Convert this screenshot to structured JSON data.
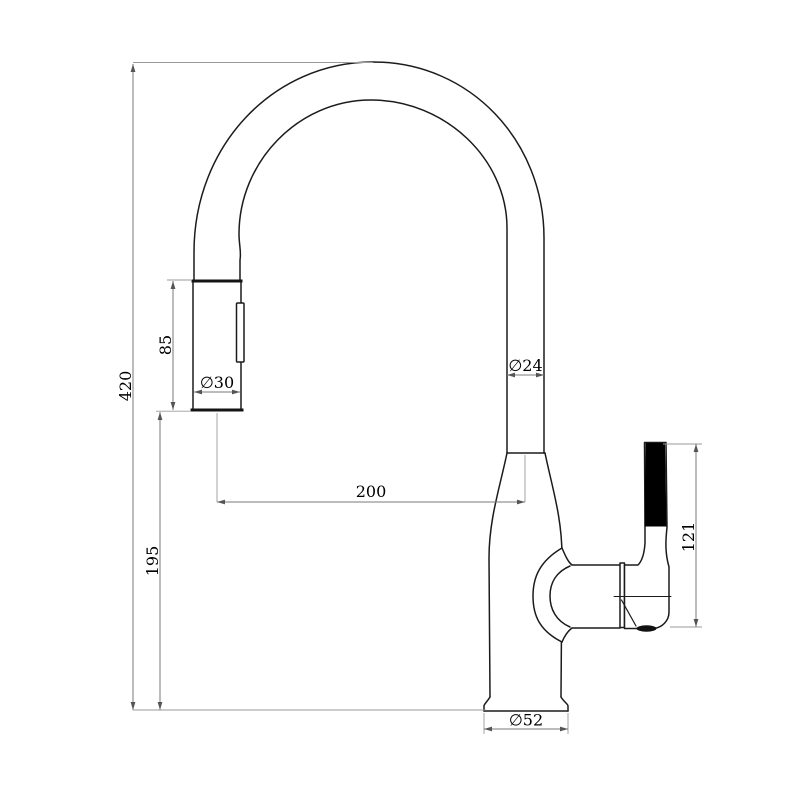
{
  "diagram": {
    "colors": {
      "background": "#ffffff",
      "outline": "#1b1b1b",
      "dimension_lines": "#7a7a7a",
      "handle_grip_fill": "#000000",
      "label_text": "#000000"
    },
    "dimensions": {
      "overall_height": "420",
      "spray_head_length": "85",
      "spray_head_diameter": "∅30",
      "spout_reach": "200",
      "head_to_base_height": "195",
      "spout_tube_diameter": "∅24",
      "handle_length": "121",
      "base_diameter": "∅52"
    }
  }
}
